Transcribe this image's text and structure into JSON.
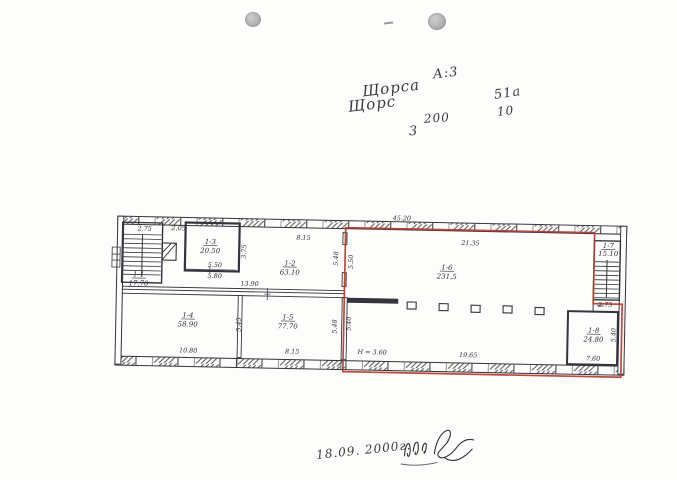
{
  "header_notes": {
    "object_code": "А:3",
    "street_line1": "Щорса",
    "street_line2": "Щорс",
    "house_a": "51а",
    "house_b": "10",
    "num_200": "200",
    "num_3": "3"
  },
  "plan": {
    "rooms": [
      {
        "label": "1-1",
        "area": "17.70"
      },
      {
        "label": "1-2",
        "area": "63.10"
      },
      {
        "label": "1-3",
        "area": "20.50"
      },
      {
        "label": "1-4",
        "area": "58.90"
      },
      {
        "label": "1-5",
        "area": "77.70"
      },
      {
        "label": "1-6",
        "area": "231,5"
      },
      {
        "label": "1-7",
        "area": "15.10"
      },
      {
        "label": "1-8",
        "area": "24.80"
      }
    ],
    "dims": {
      "stair_top": "2.75",
      "shaft_gap": "2.05",
      "room3_w_inner": "5.50",
      "room3_w_outer": "5.80",
      "room3_h": "3.75",
      "top_mid": "8.15",
      "total_width": "45.20",
      "hall_top": "21.35",
      "corridor_len": "13.90",
      "room4_w": "10.80",
      "room45_h": "5.45",
      "room5_w": "8.15",
      "red_top_left": "5.48",
      "red_top_right": "5.50",
      "red_bot_left": "5.48",
      "red_bot_right": "5.40",
      "hall_bottom": "19.65",
      "height_note": "Н = 3.60",
      "landing": "2.75",
      "room8_w": "7.60",
      "room8_h": "5.40"
    },
    "outline_color": "#b93a2e",
    "ink_color": "#35343d"
  },
  "footer": {
    "date": "18.09. 2000г."
  }
}
